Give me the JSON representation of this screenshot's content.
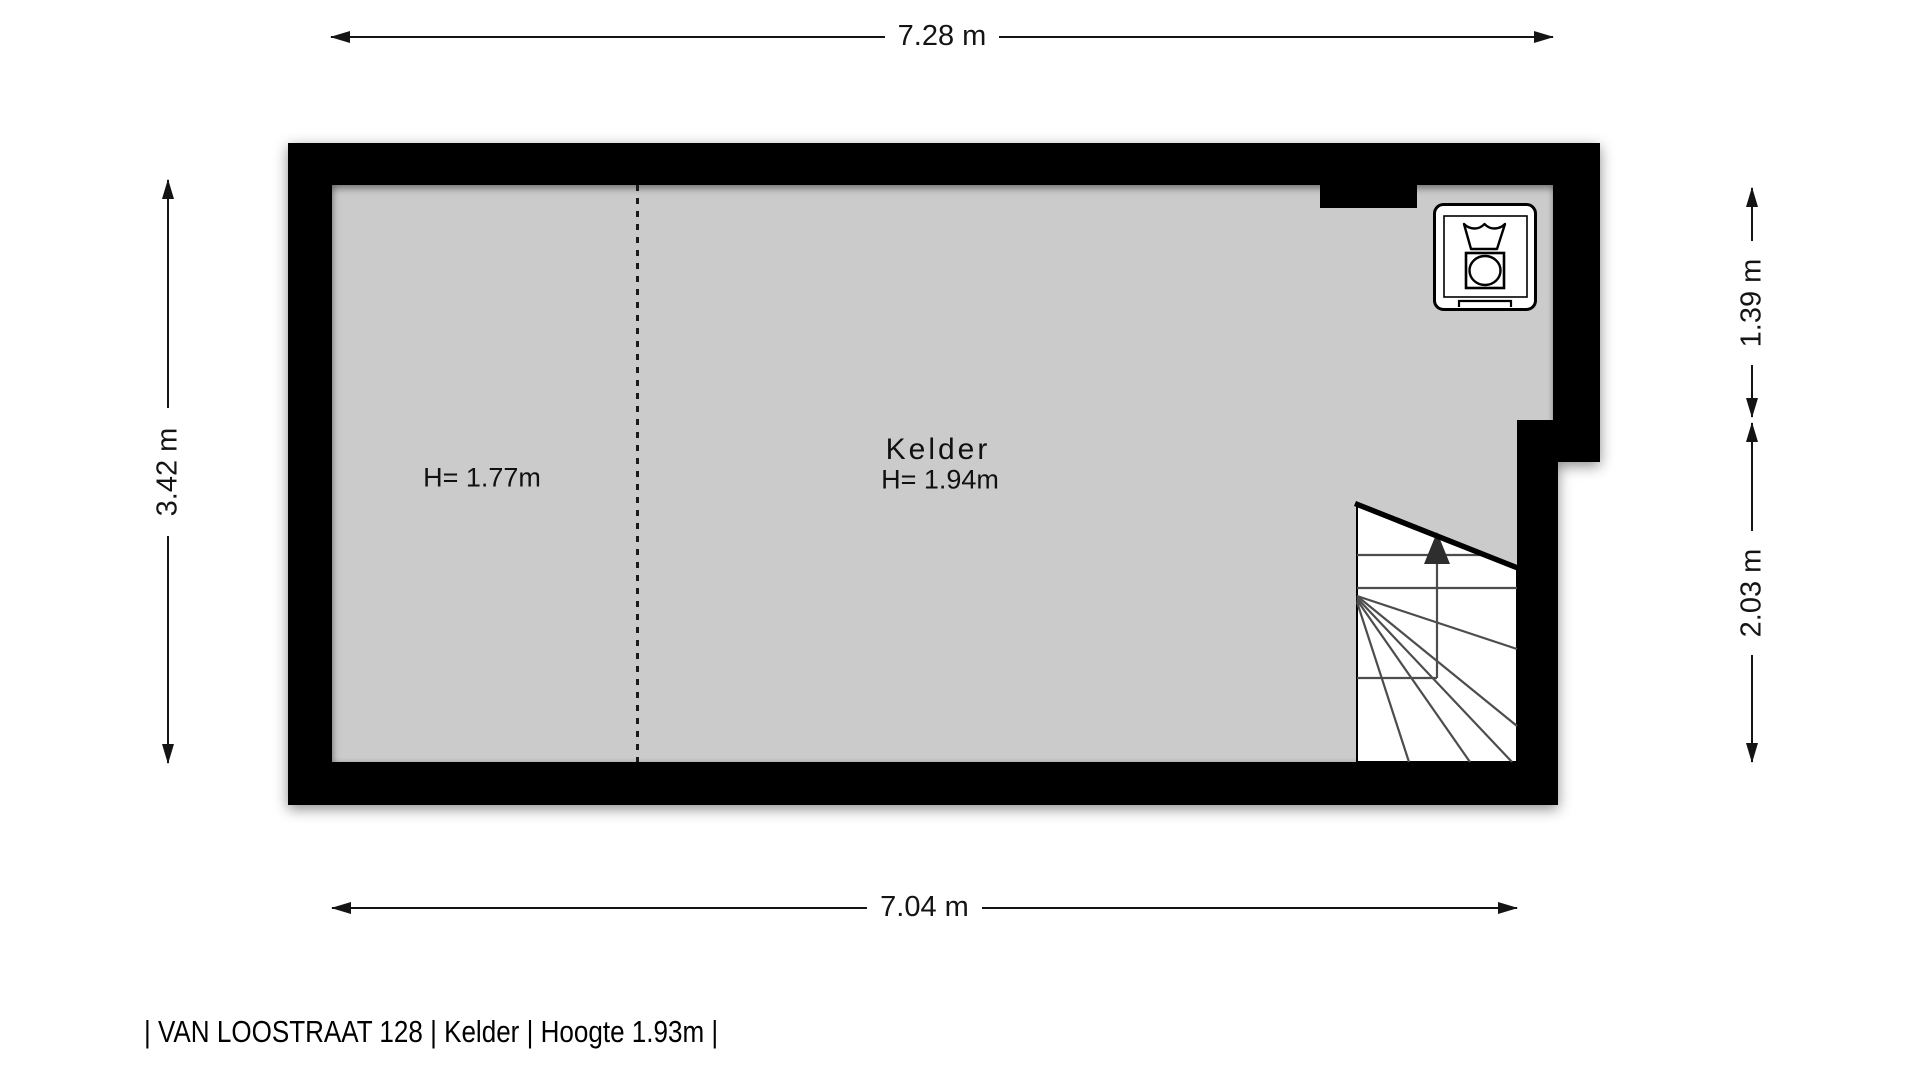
{
  "caption": "| VAN LOOSTRAAT 128 | Kelder | Hoogte 1.93m |",
  "room": {
    "name": "Kelder",
    "height_label": "H= 1.94m",
    "zone_height_label": "H= 1.77m"
  },
  "dimensions": {
    "top": "7.28 m",
    "bottom": "7.04 m",
    "left": "3.42 m",
    "right_upper": "1.39 m",
    "right_lower": "2.03 m"
  },
  "icons": {
    "washing_machine": "washing-machine-icon",
    "stairs_up_arrow": "stairs-up-arrow-icon"
  },
  "colors": {
    "background": "#ffffff",
    "wall": "#000000",
    "floor": "#cbcbcb",
    "dimension": "#141414"
  }
}
